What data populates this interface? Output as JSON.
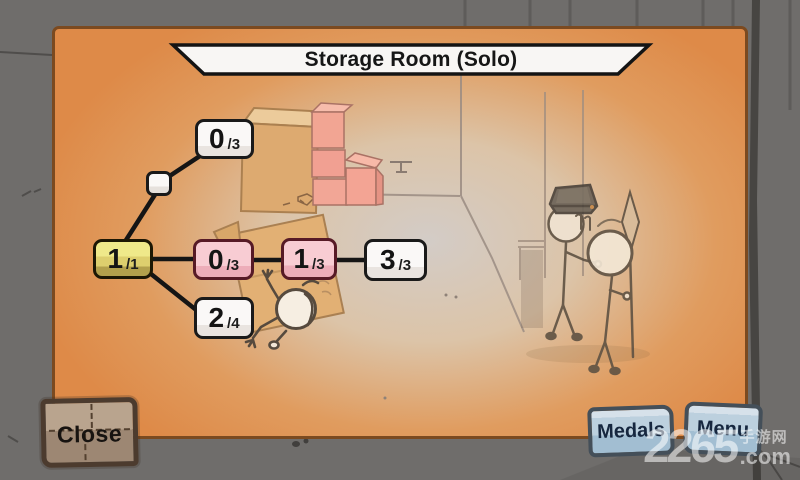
{
  "title_banner": {
    "label": "Storage Room (Solo)"
  },
  "progress_tree": {
    "nodes": [
      {
        "id": "branch-point",
        "num": "",
        "denom": "",
        "style": "small-white"
      },
      {
        "id": "top-branch",
        "num": "0",
        "denom": "/3",
        "style": "white"
      },
      {
        "id": "root",
        "num": "1",
        "denom": "/1",
        "style": "yellow"
      },
      {
        "id": "mid-left",
        "num": "0",
        "denom": "/3",
        "style": "pink"
      },
      {
        "id": "mid-right",
        "num": "1",
        "denom": "/3",
        "style": "pink"
      },
      {
        "id": "right-end",
        "num": "3",
        "denom": "/3",
        "style": "white"
      },
      {
        "id": "bottom-branch",
        "num": "2",
        "denom": "/4",
        "style": "white"
      }
    ]
  },
  "buttons": {
    "close": "Close",
    "medals": "Medals",
    "menu": "Menu"
  },
  "watermark": {
    "site_number": "2265",
    "site_cn": "手游网",
    "site_suffix": ".com"
  },
  "colors": {
    "panel_orange": "#de8a48",
    "panel_border": "#7b4a20",
    "outer_gray": "#6f6d6b",
    "node_yellow": "#ddcf6e",
    "node_pink": "#f3bcc6",
    "node_white": "#f7f5f3",
    "node_pink_border": "#571a26",
    "blue_button": "#bcd0de",
    "close_brown": "#a78f7b"
  }
}
